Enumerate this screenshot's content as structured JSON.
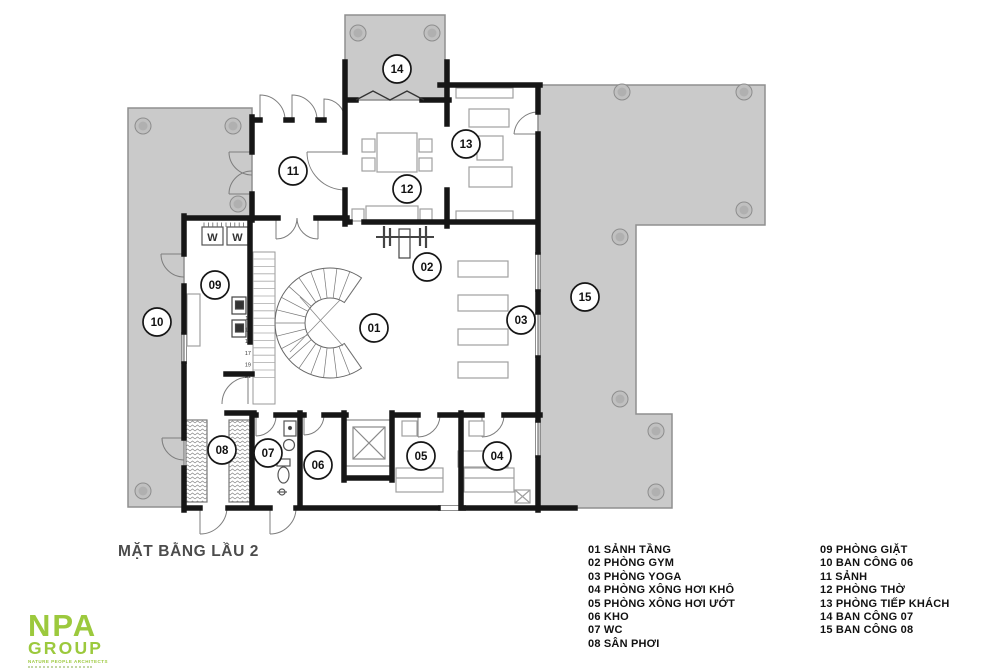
{
  "plan": {
    "title": "MẶT BẰNG LẦU 2",
    "rooms": [
      {
        "num": "01",
        "label": "SẢNH TẦNG"
      },
      {
        "num": "02",
        "label": "PHÒNG GYM"
      },
      {
        "num": "03",
        "label": "PHÒNG YOGA"
      },
      {
        "num": "04",
        "label": "PHÒNG XÔNG HƠI KHÔ"
      },
      {
        "num": "05",
        "label": "PHÒNG XÔNG HƠI ƯỚT"
      },
      {
        "num": "06",
        "label": "KHO"
      },
      {
        "num": "07",
        "label": "WC"
      },
      {
        "num": "08",
        "label": "SÂN PHƠI"
      },
      {
        "num": "09",
        "label": "PHÒNG GIẶT"
      },
      {
        "num": "10",
        "label": "BAN CÔNG 06"
      },
      {
        "num": "11",
        "label": "SẢNH"
      },
      {
        "num": "12",
        "label": "PHÒNG THỜ"
      },
      {
        "num": "13",
        "label": "PHÒNG TIẾP KHÁCH"
      },
      {
        "num": "14",
        "label": "BAN CÔNG 07"
      },
      {
        "num": "15",
        "label": "BAN CÔNG 08"
      }
    ],
    "stair_step_numbers": [
      "1",
      "3",
      "5",
      "7",
      "9",
      "11",
      "13",
      "15",
      "17",
      "19",
      "21"
    ],
    "washer_label": "W",
    "colors": {
      "balcony_fill": "#cacaca",
      "balcony_stroke": "#8f8f8f",
      "wall": "#161616",
      "accent_green": "#9cc93d"
    }
  },
  "logo": {
    "line1": "NPA",
    "line2": "GROUP",
    "tagline": "NATURE PEOPLE ARCHITECTS"
  }
}
